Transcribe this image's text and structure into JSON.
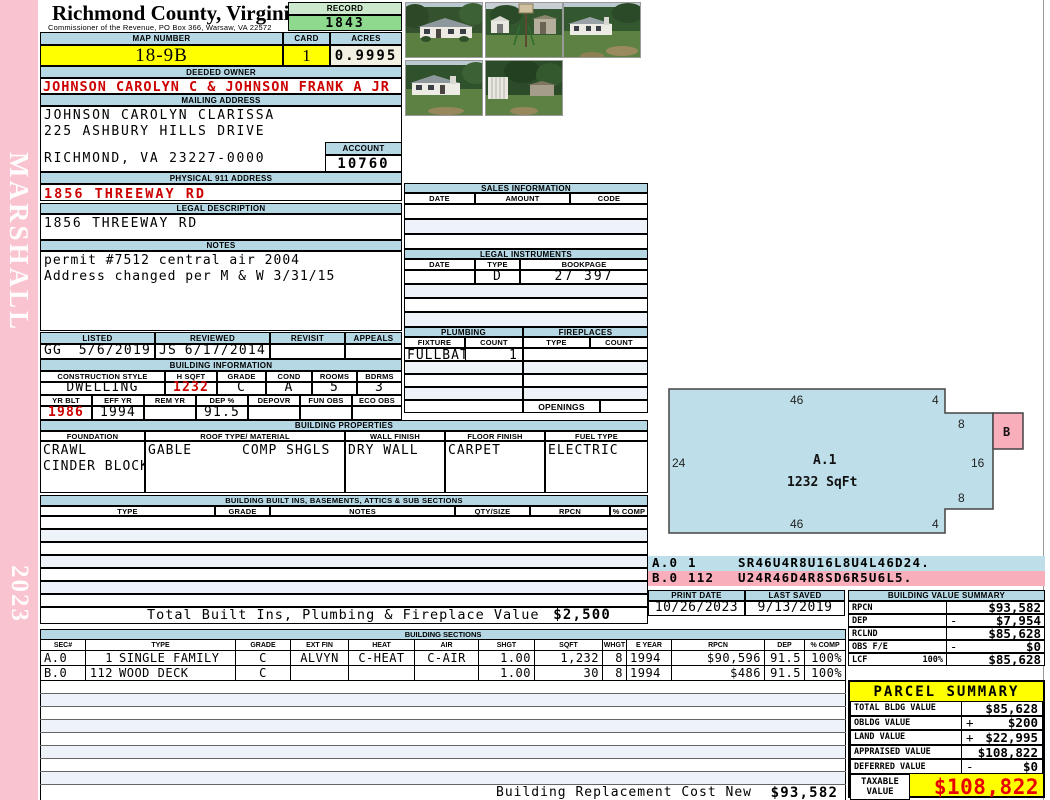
{
  "colors": {
    "bar-blue": "#b5d8e4",
    "sketch-blue": "#bedfe9",
    "pink": "#f9c3cf",
    "pink-accent": "#f9aebb",
    "green-light": "#cde9cd",
    "green": "#8fd98f",
    "yellow": "#ffff00",
    "cream": "#f1f0e2",
    "red": "#cc0000",
    "taxable-red": "#e80000",
    "row-tint": "#edf3f8"
  },
  "sidebar": {
    "agency": "MARSHALL",
    "year": "2023"
  },
  "header": {
    "county": "Richmond County, Virginia",
    "commissioner": "Commissioner of the Revenue, PO Box 366, Warsaw, VA 22572",
    "record_label": "RECORD",
    "record": "1843",
    "map_label": "MAP NUMBER",
    "map": "18-9B",
    "card_label": "CARD",
    "card": "1",
    "acres_label": "ACRES",
    "acres": "0.9995"
  },
  "owner": {
    "deeded_label": "DEEDED OWNER",
    "deeded": "JOHNSON CAROLYN C & JOHNSON FRANK A JR",
    "mailing_label": "MAILING ADDRESS",
    "mailing_line1": "JOHNSON CAROLYN CLARISSA",
    "mailing_line2": "225 ASHBURY HILLS DRIVE",
    "mailing_line3": "RICHMOND, VA 23227-0000",
    "account_label": "ACCOUNT",
    "account": "10760",
    "physical_label": "PHYSICAL 911 ADDRESS",
    "physical": "1856 THREEWAY RD",
    "legal_label": "LEGAL DESCRIPTION",
    "legal": "1856 THREEWAY RD",
    "notes_label": "NOTES",
    "notes_line1": "permit #7512 central air 2004",
    "notes_line2": "Address changed per M & W 3/31/15"
  },
  "review": {
    "listed_label": "LISTED",
    "reviewed_label": "REVIEWED",
    "revisit_label": "REVISIT",
    "appeals_label": "APPEALS",
    "listed_by": "GG",
    "listed_date": "5/6/2019",
    "reviewed_by": "JS",
    "reviewed_date": "6/17/2014"
  },
  "building_info": {
    "title": "BUILDING INFORMATION",
    "style_label": "CONSTRUCTION STYLE",
    "style": "DWELLING",
    "hsqft_label": "H SQFT",
    "hsqft": "1232",
    "grade_label": "GRADE",
    "grade": "C",
    "cond_label": "COND",
    "cond": "A",
    "rooms_label": "ROOMS",
    "rooms": "5",
    "bdrms_label": "BDRMS",
    "bdrms": "3",
    "yrblt_label": "YR BLT",
    "yrblt": "1986",
    "effyr_label": "EFF YR",
    "effyr": "1994",
    "remyr_label": "REM YR",
    "remyr": "",
    "dep_label": "DEP %",
    "dep": "91.5",
    "depovr_label": "DEPOVR",
    "funobs_label": "FUN OBS",
    "ecoobs_label": "ECO OBS"
  },
  "sales": {
    "title": "SALES INFORMATION",
    "col_date": "DATE",
    "col_amount": "AMOUNT",
    "col_code": "CODE"
  },
  "instruments": {
    "title": "LEGAL INSTRUMENTS",
    "col_date": "DATE",
    "col_type": "TYPE",
    "col_bookpage": "BOOKPAGE",
    "row_type": "D",
    "row_bookpage": "27 397"
  },
  "plumbing": {
    "title": "PLUMBING",
    "col_fixture": "FIXTURE",
    "col_count": "COUNT",
    "fixture": "FULLBATH",
    "count": "1"
  },
  "fireplaces": {
    "title": "FIREPLACES",
    "col_type": "TYPE",
    "col_count": "COUNT",
    "openings_label": "OPENINGS"
  },
  "properties": {
    "title": "BUILDING PROPERTIES",
    "foundation_label": "FOUNDATION",
    "foundation_line1": "CRAWL",
    "foundation_line2": "CINDER BLOCK",
    "roof_label": "ROOF TYPE/ MATERIAL",
    "roof_type": "GABLE",
    "roof_material": "COMP SHGLS",
    "wall_label": "WALL FINISH",
    "wall": "DRY WALL",
    "floor_label": "FLOOR FINISH",
    "floor": "CARPET",
    "fuel_label": "FUEL TYPE",
    "fuel": "ELECTRIC"
  },
  "builtins": {
    "title": "BUILDING BUILT INS, BASEMENTS, ATTICS & SUB SECTIONS",
    "col_type": "TYPE",
    "col_grade": "GRADE",
    "col_notes": "NOTES",
    "col_qty": "QTY/SIZE",
    "col_rpcn": "RPCN",
    "col_comp": "% COMP",
    "total_label": "Total Built Ins, Plumbing & Fireplace Value",
    "total_value": "$2,500"
  },
  "sketch": {
    "area_label": "A.1",
    "area_sqft": "1232 SqFt",
    "b_label": "B",
    "dim_top": "46",
    "dim_top_step": "4",
    "dim_right_upper": "8",
    "dim_right": "16",
    "dim_right_lower": "8",
    "dim_bottom_step": "4",
    "dim_bottom": "46",
    "dim_left": "24",
    "vectors": [
      {
        "sec": "A.0",
        "code": "1",
        "path": "SR46U4R8U16L8U4L46D24."
      },
      {
        "sec": "B.0",
        "code": "112",
        "path": "U24R46D4R8SD6R5U6L5."
      }
    ]
  },
  "dates": {
    "print_label": "PRINT DATE",
    "print": "10/26/2023",
    "saved_label": "LAST SAVED",
    "saved": "9/13/2019"
  },
  "value_summary": {
    "title": "BUILDING VALUE SUMMARY",
    "rows": [
      {
        "label": "RPCN",
        "sign": "",
        "value": "$93,582"
      },
      {
        "label": "DEP",
        "sign": "-",
        "value": "$7,954"
      },
      {
        "label": "RCLND",
        "sign": "",
        "value": "$85,628"
      },
      {
        "label": "OBS F/E",
        "sign": "-",
        "value": "$0"
      },
      {
        "label": "LCF",
        "pct": "100%",
        "sign": "",
        "value": "$85,628"
      }
    ]
  },
  "sections": {
    "title": "BUILDING SECTIONS",
    "cols": [
      "SEC#",
      "TYPE",
      "GRADE",
      "EXT FIN",
      "HEAT",
      "AIR",
      "SHGT",
      "SQFT",
      "WHGT",
      "E YEAR",
      "RPCN",
      "DEP",
      "% COMP"
    ],
    "rows": [
      {
        "sec": "A.0",
        "code": "1",
        "name": "SINGLE FAMILY",
        "grade": "C",
        "extfin": "ALVYN",
        "heat": "C-HEAT",
        "air": "C-AIR",
        "shgt": "1.00",
        "sqft": "1,232",
        "whgt": "8",
        "eyear": "1994",
        "rpcn": "$90,596",
        "dep": "91.5",
        "comp": "100%"
      },
      {
        "sec": "B.0",
        "code": "112",
        "name": "WOOD DECK",
        "grade": "C",
        "extfin": "",
        "heat": "",
        "air": "",
        "shgt": "1.00",
        "sqft": "30",
        "whgt": "8",
        "eyear": "1994",
        "rpcn": "$486",
        "dep": "91.5",
        "comp": "100%"
      }
    ],
    "replacement_label": "Building Replacement Cost New",
    "replacement_value": "$93,582"
  },
  "parcel": {
    "title": "PARCEL SUMMARY",
    "rows": [
      {
        "label": "TOTAL BLDG VALUE",
        "sign": "",
        "value": "$85,628"
      },
      {
        "label": "OBLDG VALUE",
        "sign": "+",
        "value": "$200"
      },
      {
        "label": "LAND VALUE",
        "sign": "+",
        "value": "$22,995"
      },
      {
        "label": "APPRAISED VALUE",
        "sign": "",
        "value": "$108,822"
      },
      {
        "label": "DEFERRED VALUE",
        "sign": "-",
        "value": "$0"
      }
    ],
    "taxable_label1": "TAXABLE",
    "taxable_label2": "VALUE",
    "taxable": "$108,822"
  },
  "photos": [
    "house-front",
    "yard-basketball-hoop",
    "house-side-yard",
    "house-lawn",
    "shed-and-trailer"
  ]
}
